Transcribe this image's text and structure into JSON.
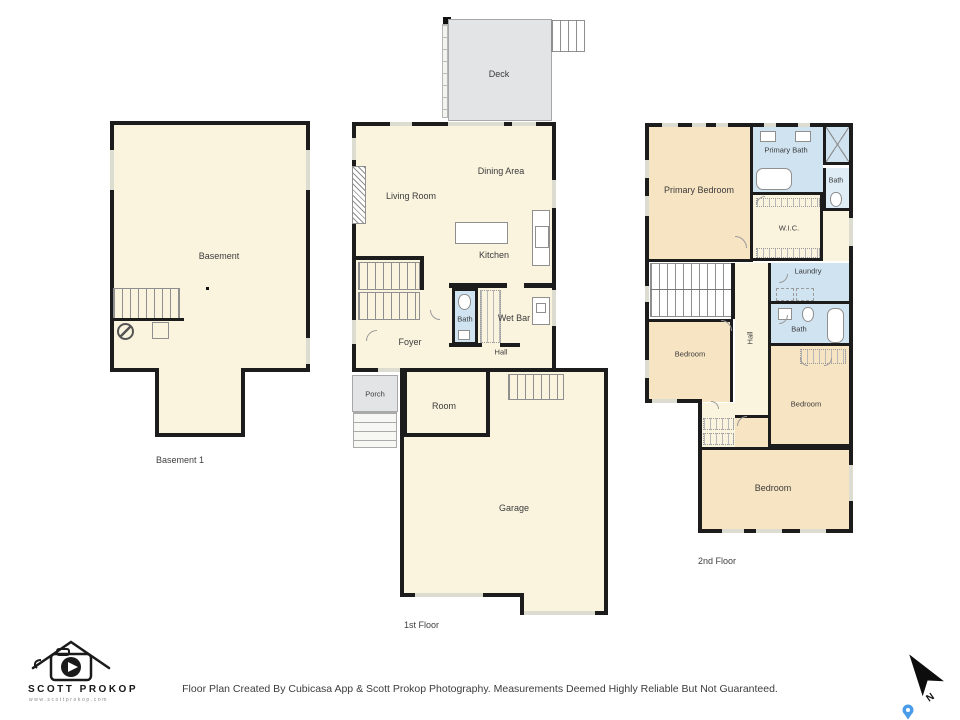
{
  "footer": {
    "disclaimer": "Floor Plan Created By Cubicasa App & Scott Prokop Photography. Measurements Deemed Highly Reliable But Not Guaranteed."
  },
  "branding": {
    "name": "SCOTT PROKOP",
    "website": "www.scottprokop.com"
  },
  "compass": {
    "north_label": "N"
  },
  "floors": {
    "basement": {
      "caption": "Basement 1",
      "rooms": {
        "basement": "Basement"
      }
    },
    "first": {
      "caption": "1st Floor",
      "rooms": {
        "deck": "Deck",
        "living_room": "Living Room",
        "dining_area": "Dining Area",
        "kitchen": "Kitchen",
        "bath": "Bath",
        "wet_bar": "Wet Bar",
        "foyer": "Foyer",
        "hall": "Hall",
        "porch": "Porch",
        "room": "Room",
        "garage": "Garage"
      }
    },
    "second": {
      "caption": "2nd Floor",
      "rooms": {
        "primary_bedroom": "Primary Bedroom",
        "primary_bath": "Primary Bath",
        "bath_upper": "Bath",
        "wic": "W.I.C.",
        "laundry": "Laundry",
        "bath_hall": "Bath",
        "bedroom_left": "Bedroom",
        "hall": "Hall",
        "bedroom_right": "Bedroom",
        "bedroom_bottom": "Bedroom"
      }
    }
  },
  "colors": {
    "room_cream": "#FAF4DF",
    "bedroom_tan": "#F7E4C2",
    "bath_blue": "#CFE3F1",
    "pale_blue": "#DFEDF7",
    "deck_gray": "#E3E4E6",
    "wall": "#1C1C1C",
    "pin_blue": "#4A9BE8"
  }
}
